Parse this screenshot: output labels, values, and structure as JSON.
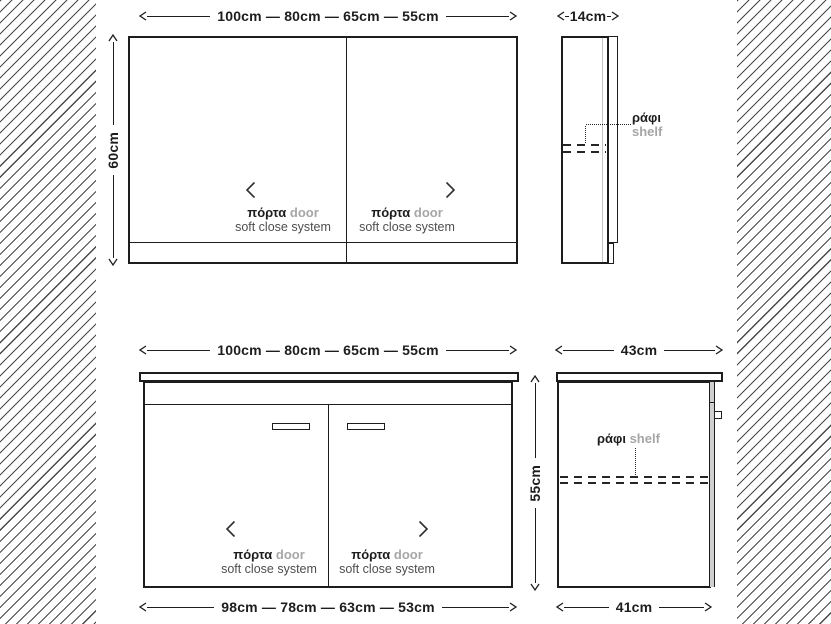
{
  "drawing": {
    "colors": {
      "line": "#1d1d1d",
      "gray_text": "#a6a6a6",
      "subtitle_text": "#4e4e4e",
      "panel_gray": "#cfcfcf"
    },
    "top_cabinet": {
      "front": {
        "width_dim": "100cm — 80cm — 65cm — 55cm",
        "height_dim": "60cm",
        "doors": [
          {
            "name_gr": "πόρτα",
            "name_en": "door",
            "system": "soft close system"
          },
          {
            "name_gr": "πόρτα",
            "name_en": "door",
            "system": "soft close system"
          }
        ]
      },
      "side": {
        "depth_dim": "14cm",
        "shelf_gr": "ράφι",
        "shelf_en": "shelf"
      }
    },
    "bottom_cabinet": {
      "front": {
        "top_width_dim": "100cm — 80cm — 65cm — 55cm",
        "bottom_width_dim": "98cm — 78cm — 63cm — 53cm",
        "height_dim": "55cm",
        "doors": [
          {
            "name_gr": "πόρτα",
            "name_en": "door",
            "system": "soft close system"
          },
          {
            "name_gr": "πόρτα",
            "name_en": "door",
            "system": "soft close system"
          }
        ]
      },
      "side": {
        "top_depth_dim": "43cm",
        "bottom_depth_dim": "41cm",
        "shelf_gr": "ράφι",
        "shelf_en": "shelf"
      }
    }
  }
}
